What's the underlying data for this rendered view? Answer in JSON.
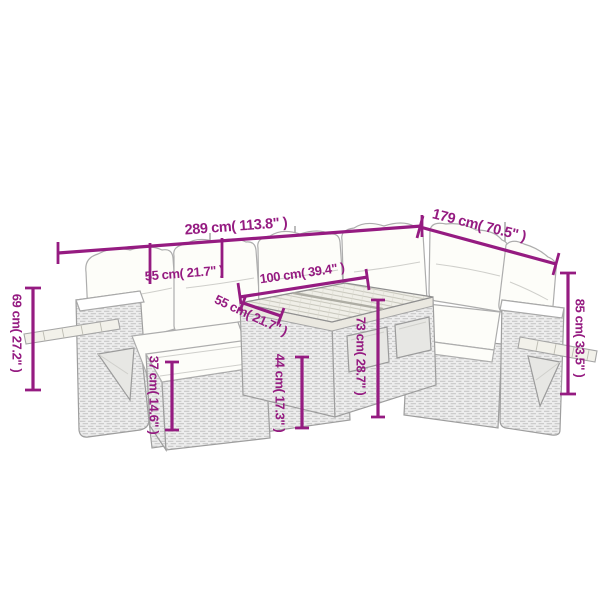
{
  "colors": {
    "dimension": "#951b81",
    "sketch": "#a9a9a9"
  },
  "dimensions": {
    "total_width": {
      "label": "289 cm( 113.8\" )"
    },
    "total_depth": {
      "label": "179 cm( 70.5\" )"
    },
    "seat_width": {
      "label": "55 cm( 21.7\" )"
    },
    "table_width": {
      "label": "100 cm( 39.4\" )"
    },
    "table_depth": {
      "label": "55 cm( 21.7\" )"
    },
    "table_height": {
      "label": "73 cm( 28.7\" )"
    },
    "table_base_height": {
      "label": "44 cm( 17.3\" )"
    },
    "footstool_height": {
      "label": "37 cm( 14.6\" )"
    },
    "armrest_height": {
      "label": "69 cm( 27.2\" )"
    },
    "backrest_height": {
      "label": "85 cm( 33.5\" )"
    }
  }
}
